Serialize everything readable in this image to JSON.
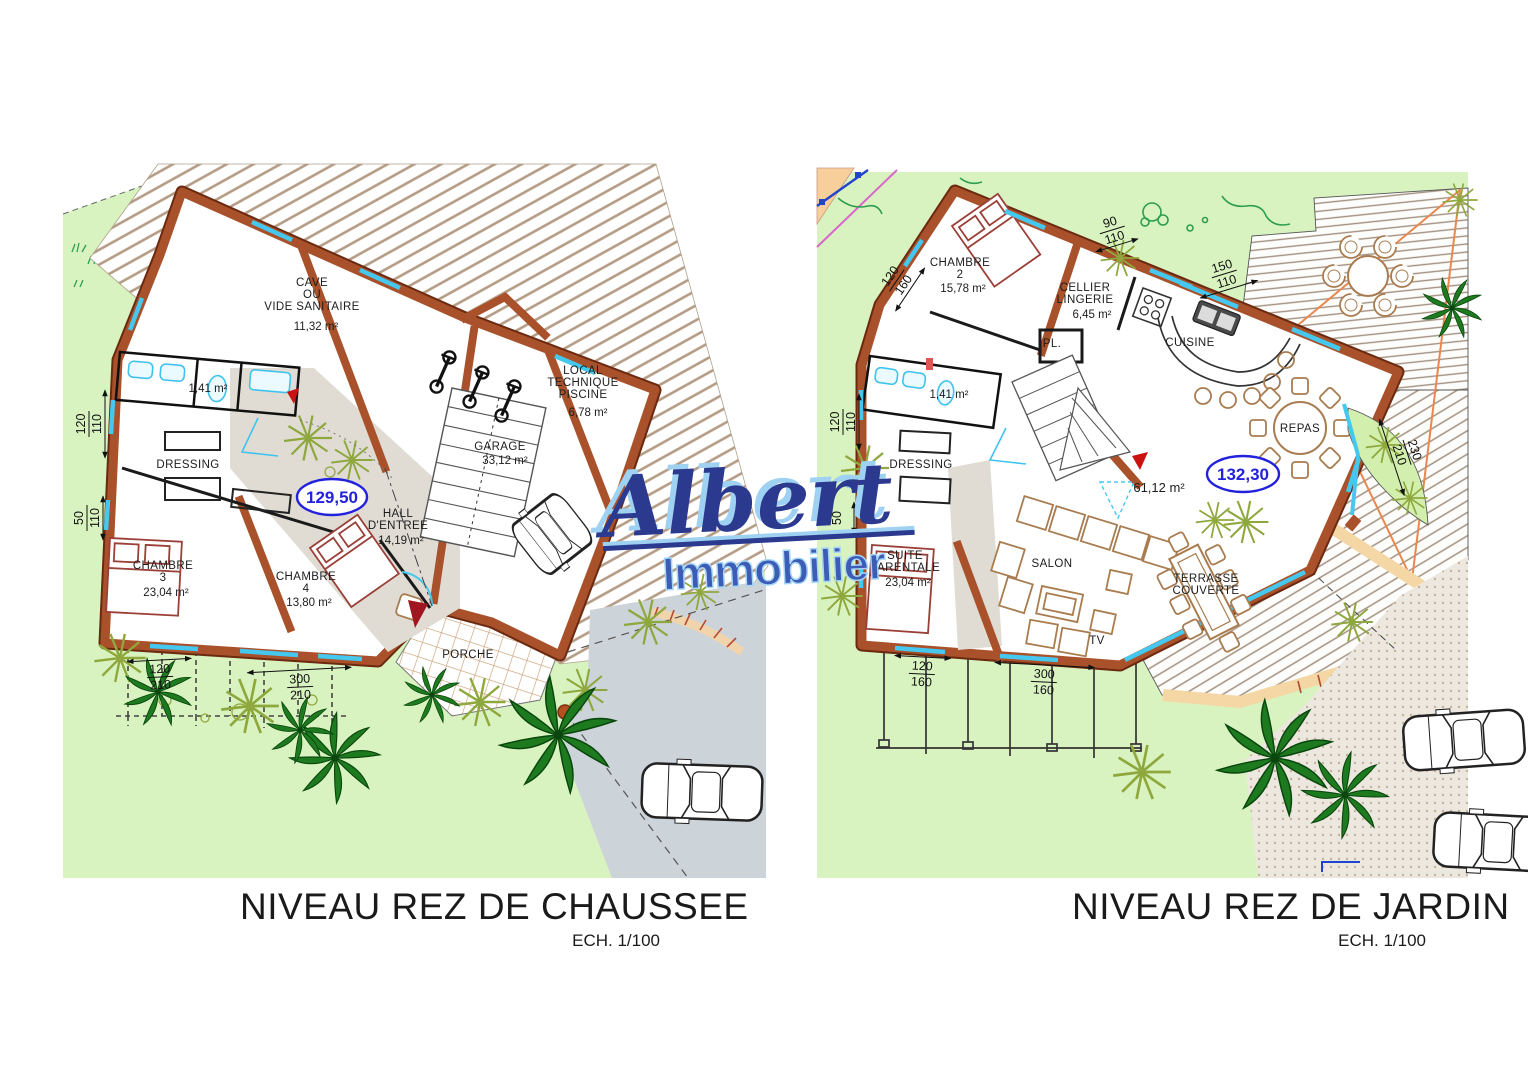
{
  "logo": {
    "brand": "Albert",
    "subtitle": "Immobilier",
    "color_dark": "#2b3a8e",
    "color_light": "#9fd2f2"
  },
  "left_plan": {
    "caption": "NIVEAU REZ DE CHAUSSEE",
    "scale": "ECH. 1/100",
    "total": "129,50",
    "rooms": {
      "cave_l1": "CAVE",
      "cave_l2": "OU",
      "cave_l3": "VIDE SANITAIRE",
      "cave_area": "11,32 m²",
      "local_l1": "LOCAL",
      "local_l2": "TECHNIQUE",
      "local_l3": "PISCINE",
      "local_area": "6,78 m²",
      "garage": "GARAGE",
      "garage_area": "33,12 m²",
      "bath_area": "1,41 m²",
      "dressing": "DRESSING",
      "hall_l1": "HALL",
      "hall_l2": "D'ENTREE",
      "hall_area": "14,19 m²",
      "ch3_l1": "CHAMBRE",
      "ch3_l2": "3",
      "ch3_area": "23,04 m²",
      "ch4_l1": "CHAMBRE",
      "ch4_l2": "4",
      "ch4_area": "13,80 m²",
      "porche": "PORCHE"
    },
    "dims": {
      "w_upper_a": "120",
      "w_upper_b": "110",
      "w_lower_a": "50",
      "w_lower_b": "110",
      "s1_a": "120",
      "s1_b": "210",
      "s2_a": "300",
      "s2_b": "210"
    }
  },
  "right_plan": {
    "caption": "NIVEAU REZ DE JARDIN",
    "scale": "ECH. 1/100",
    "total": "132,30",
    "area_note": "61,12 m²",
    "rooms": {
      "ch2_l1": "CHAMBRE",
      "ch2_l2": "2",
      "ch2_area": "15,78 m²",
      "cellier_l1": "CELLIER",
      "cellier_l2": "LINGERIE",
      "cellier_area": "6,45 m²",
      "pl": "PL.",
      "cuisine": "CUISINE",
      "repas": "REPAS",
      "bath_area": "1,41 m²",
      "dressing": "DRESSING",
      "suite_l1": "SUITE",
      "suite_l2": "PARENTALE",
      "suite_area": "23,04 m²",
      "salon": "SALON",
      "tv": "TV",
      "terrasse_l1": "TERRASSE",
      "terrasse_l2": "COUVERTE"
    },
    "dims": {
      "top1_a": "90",
      "top1_b": "110",
      "top2_a": "150",
      "top2_b": "110",
      "nw_a": "120",
      "nw_b": "160",
      "w_upper_a": "120",
      "w_upper_b": "110",
      "w_lower_a": "50",
      "e_a": "230",
      "e_b": "210",
      "s1_a": "120",
      "s1_b": "160",
      "s2_a": "300",
      "s2_b": "160"
    }
  },
  "colors": {
    "wall": "#a8512a",
    "wall_edge": "#6b2a10",
    "lawn": "#d9f3c0",
    "roof_hatch": "#b49b84",
    "driveway": "#ccd3d9",
    "window": "#45c8f0",
    "total_blue": "#2222dd",
    "furniture_tan": "#a97c4f",
    "furniture_red": "#9a4038",
    "palm_green": "#1e7a1f",
    "plant_olive": "#8fa83e",
    "sand": "#f5d7a5"
  }
}
